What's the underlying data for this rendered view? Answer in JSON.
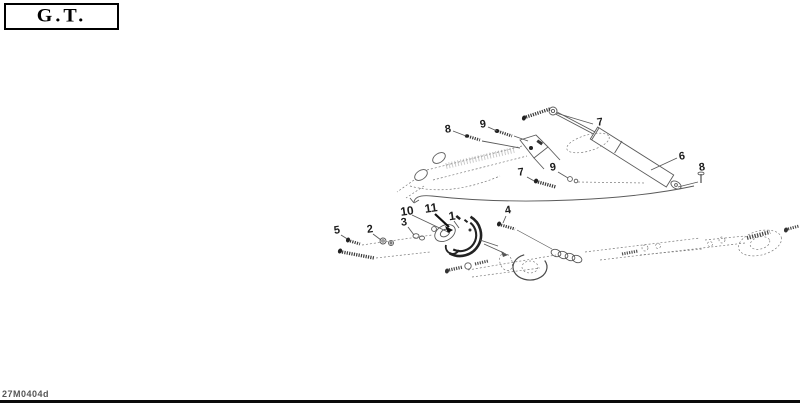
{
  "model_box": {
    "label": "G.T."
  },
  "figure": {
    "code": "27M0404d"
  },
  "callouts": [
    {
      "id": "8-top",
      "label": "8"
    },
    {
      "id": "9-top",
      "label": "9"
    },
    {
      "id": "7-top",
      "label": "7"
    },
    {
      "id": "6",
      "label": "6"
    },
    {
      "id": "8-right",
      "label": "8"
    },
    {
      "id": "7-mid",
      "label": "7"
    },
    {
      "id": "9-mid",
      "label": "9"
    },
    {
      "id": "10",
      "label": "10"
    },
    {
      "id": "11",
      "label": "11"
    },
    {
      "id": "1",
      "label": "1"
    },
    {
      "id": "4",
      "label": "4"
    },
    {
      "id": "5",
      "label": "5"
    },
    {
      "id": "2",
      "label": "2"
    },
    {
      "id": "3",
      "label": "3"
    }
  ],
  "colors": {
    "line": "#5a5a5a",
    "dark": "#1c1c1c",
    "phantom": "#7a7a7a"
  }
}
